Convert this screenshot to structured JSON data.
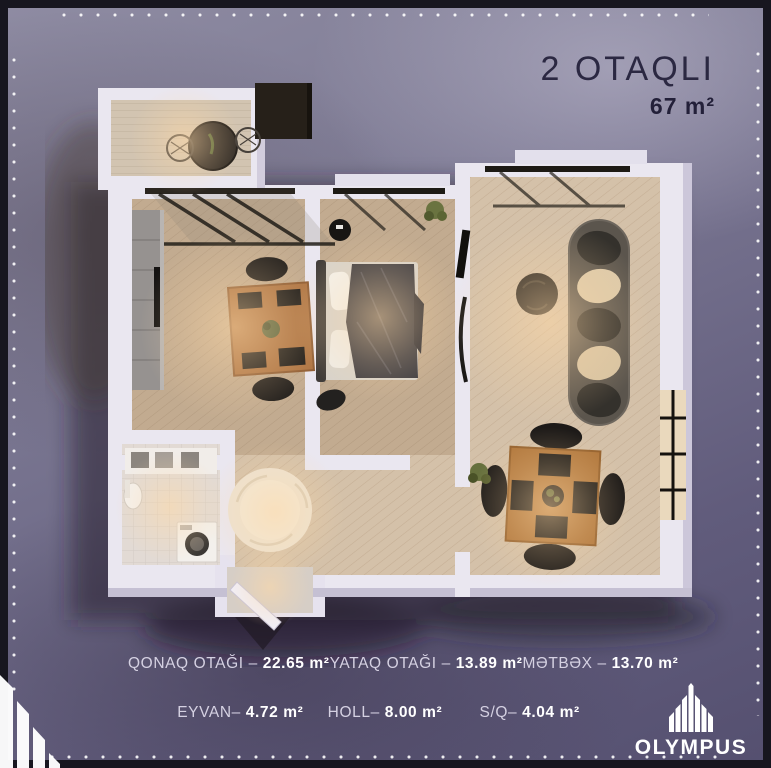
{
  "header": {
    "title": "2 OTAQLI",
    "area": "67 m²"
  },
  "legend": {
    "items": [
      {
        "name": "QONAQ OTAĞI",
        "sep": " – ",
        "value": "22.65 m²"
      },
      {
        "name": "YATAQ OTAĞI",
        "sep": " – ",
        "value": "13.89 m²"
      },
      {
        "name": "MƏTBƏX",
        "sep": " – ",
        "value": "13.70 m²"
      },
      {
        "name": "EYVAN",
        "sep": "– ",
        "value": "4.72 m²"
      },
      {
        "name": "HOLL",
        "sep": "– ",
        "value": "8.00 m²"
      },
      {
        "name": "S/Q",
        "sep": "– ",
        "value": "4.04 m²"
      }
    ]
  },
  "brand": {
    "name": "OLYMPUS"
  },
  "floorplan": {
    "type": "apartment-floor-plan-3d-render",
    "rooms": [
      {
        "id": "living-room",
        "label": "QONAQ OTAĞI",
        "area_m2": "22.65"
      },
      {
        "id": "bedroom",
        "label": "YATAQ OTAĞI",
        "area_m2": "13.89"
      },
      {
        "id": "kitchen",
        "label": "MƏTBƏX",
        "area_m2": "13.70"
      },
      {
        "id": "balcony",
        "label": "EYVAN",
        "area_m2": "4.72"
      },
      {
        "id": "hall",
        "label": "HOLL",
        "area_m2": "8.00"
      },
      {
        "id": "bathroom",
        "label": "S/Q",
        "area_m2": "4.04"
      }
    ]
  },
  "colors": {
    "frame_border": "#17161f",
    "background_top": "#8e8ba2",
    "background_bottom": "#555070",
    "title_text": "#2b2842",
    "legend_text": "#ffffff",
    "wall": "#eae7f0",
    "wood_floor": "#c2ab90",
    "glow": "#ffd9a6"
  }
}
